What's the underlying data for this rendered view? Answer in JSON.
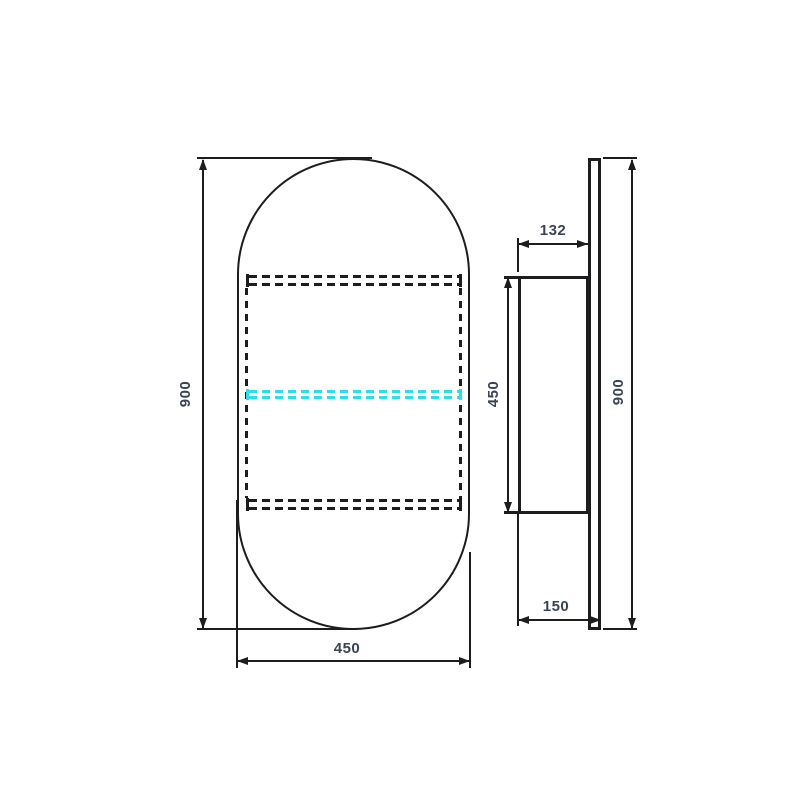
{
  "drawing": {
    "type": "technical-drawing",
    "subject": "pill-shaped-mirror-cabinet",
    "views": {
      "front": {
        "overall_height_label": "900",
        "overall_width_label": "450"
      },
      "side": {
        "cabinet_depth_label": "132",
        "cabinet_height_label": "450",
        "total_depth_label": "150",
        "overall_height_label": "900"
      }
    },
    "colors": {
      "line": "#1d1d1f",
      "dimension_text": "#3b4455",
      "shelf_highlight": "#2bdfea",
      "background": "#ffffff"
    }
  }
}
